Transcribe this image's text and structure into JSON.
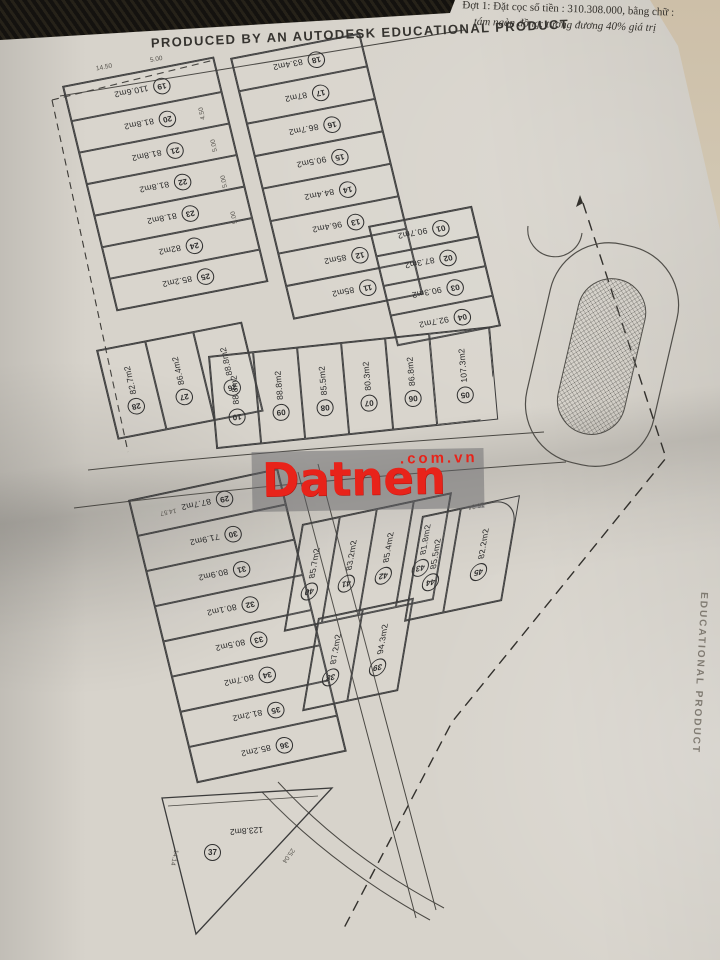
{
  "document": {
    "deposit_note_line1": "Đợt 1: Đặt cọc số tiền : 310.308.000, bằng chữ :",
    "deposit_note_line2": "tám ngàn đồng; tương đương 40% giá trị",
    "banner": "PRODUCED BY AN AUTODESK EDUCATIONAL PRODUCT",
    "side_banner": "EDUCATIONAL PRODUCT"
  },
  "watermark": {
    "brand": "Datnen",
    "suffix": ".com.vn",
    "color": "#e8231a"
  },
  "map": {
    "groups": [
      {
        "id": "left-column",
        "plots": [
          {
            "no": "19",
            "area": "110.6m2"
          },
          {
            "no": "20",
            "area": "81.8m2"
          },
          {
            "no": "21",
            "area": "81.8m2"
          },
          {
            "no": "22",
            "area": "81.8m2"
          },
          {
            "no": "23",
            "area": "81.8m2"
          },
          {
            "no": "24",
            "area": "82m2"
          },
          {
            "no": "25",
            "area": "85.2m2"
          }
        ]
      },
      {
        "id": "left-strips",
        "plots": [
          {
            "no": "28",
            "area": "82.7m2"
          },
          {
            "no": "27",
            "area": "86.4m2"
          },
          {
            "no": "26",
            "area": "88.8m2"
          }
        ]
      },
      {
        "id": "mid-column",
        "plots": [
          {
            "no": "18",
            "area": "83.4m2"
          },
          {
            "no": "17",
            "area": "87m2"
          },
          {
            "no": "16",
            "area": "86.7m2"
          },
          {
            "no": "15",
            "area": "90.5m2"
          },
          {
            "no": "14",
            "area": "84.4m2"
          },
          {
            "no": "13",
            "area": "96.4m2"
          },
          {
            "no": "12",
            "area": "85m2"
          },
          {
            "no": "11",
            "area": "85m2"
          }
        ]
      },
      {
        "id": "right-column",
        "plots": [
          {
            "no": "01",
            "area": "90.7m2"
          },
          {
            "no": "02",
            "area": "87.3m2"
          },
          {
            "no": "03",
            "area": "90.3m2"
          },
          {
            "no": "04",
            "area": "92.7m2"
          }
        ]
      },
      {
        "id": "mid-row",
        "plots": [
          {
            "no": "10",
            "area": "88.8m2"
          },
          {
            "no": "09",
            "area": "88.8m2"
          },
          {
            "no": "08",
            "area": "85.5m2"
          },
          {
            "no": "07",
            "area": "80.3m2"
          },
          {
            "no": "06",
            "area": "86.8m2"
          },
          {
            "no": "05",
            "area": "107.3m2"
          }
        ]
      },
      {
        "id": "south-strip",
        "plots": [
          {
            "no": "29",
            "area": "87.7m2"
          },
          {
            "no": "30",
            "area": "71.9m2"
          },
          {
            "no": "31",
            "area": "80.9m2"
          },
          {
            "no": "32",
            "area": "80.1m2"
          },
          {
            "no": "33",
            "area": "80.5m2"
          },
          {
            "no": "34",
            "area": "80.7m2"
          },
          {
            "no": "35",
            "area": "81.2m2"
          },
          {
            "no": "36",
            "area": "85.2m2"
          }
        ]
      },
      {
        "id": "cluster-top",
        "plots": [
          {
            "no": "40",
            "area": "85.7m2"
          },
          {
            "no": "41",
            "area": "83.2m2"
          },
          {
            "no": "42",
            "area": "85.4m2"
          },
          {
            "no": "43",
            "area": "81.8m2"
          }
        ]
      },
      {
        "id": "cluster-bottom",
        "plots": [
          {
            "no": "38",
            "area": "87.2m2"
          },
          {
            "no": "39",
            "area": "94.3m2"
          }
        ]
      },
      {
        "id": "cluster-right",
        "plots": [
          {
            "no": "44",
            "area": "85.5m2"
          },
          {
            "no": "45",
            "area": "82.2m2"
          }
        ]
      }
    ],
    "triangle_plot": {
      "no": "37",
      "area": "123.8m2"
    },
    "dimensions": [
      "14.57",
      "16.34",
      "14.14",
      "25.04",
      "5.00",
      "5.00",
      "5.00",
      "4.50",
      "14.50",
      "5.00"
    ]
  }
}
